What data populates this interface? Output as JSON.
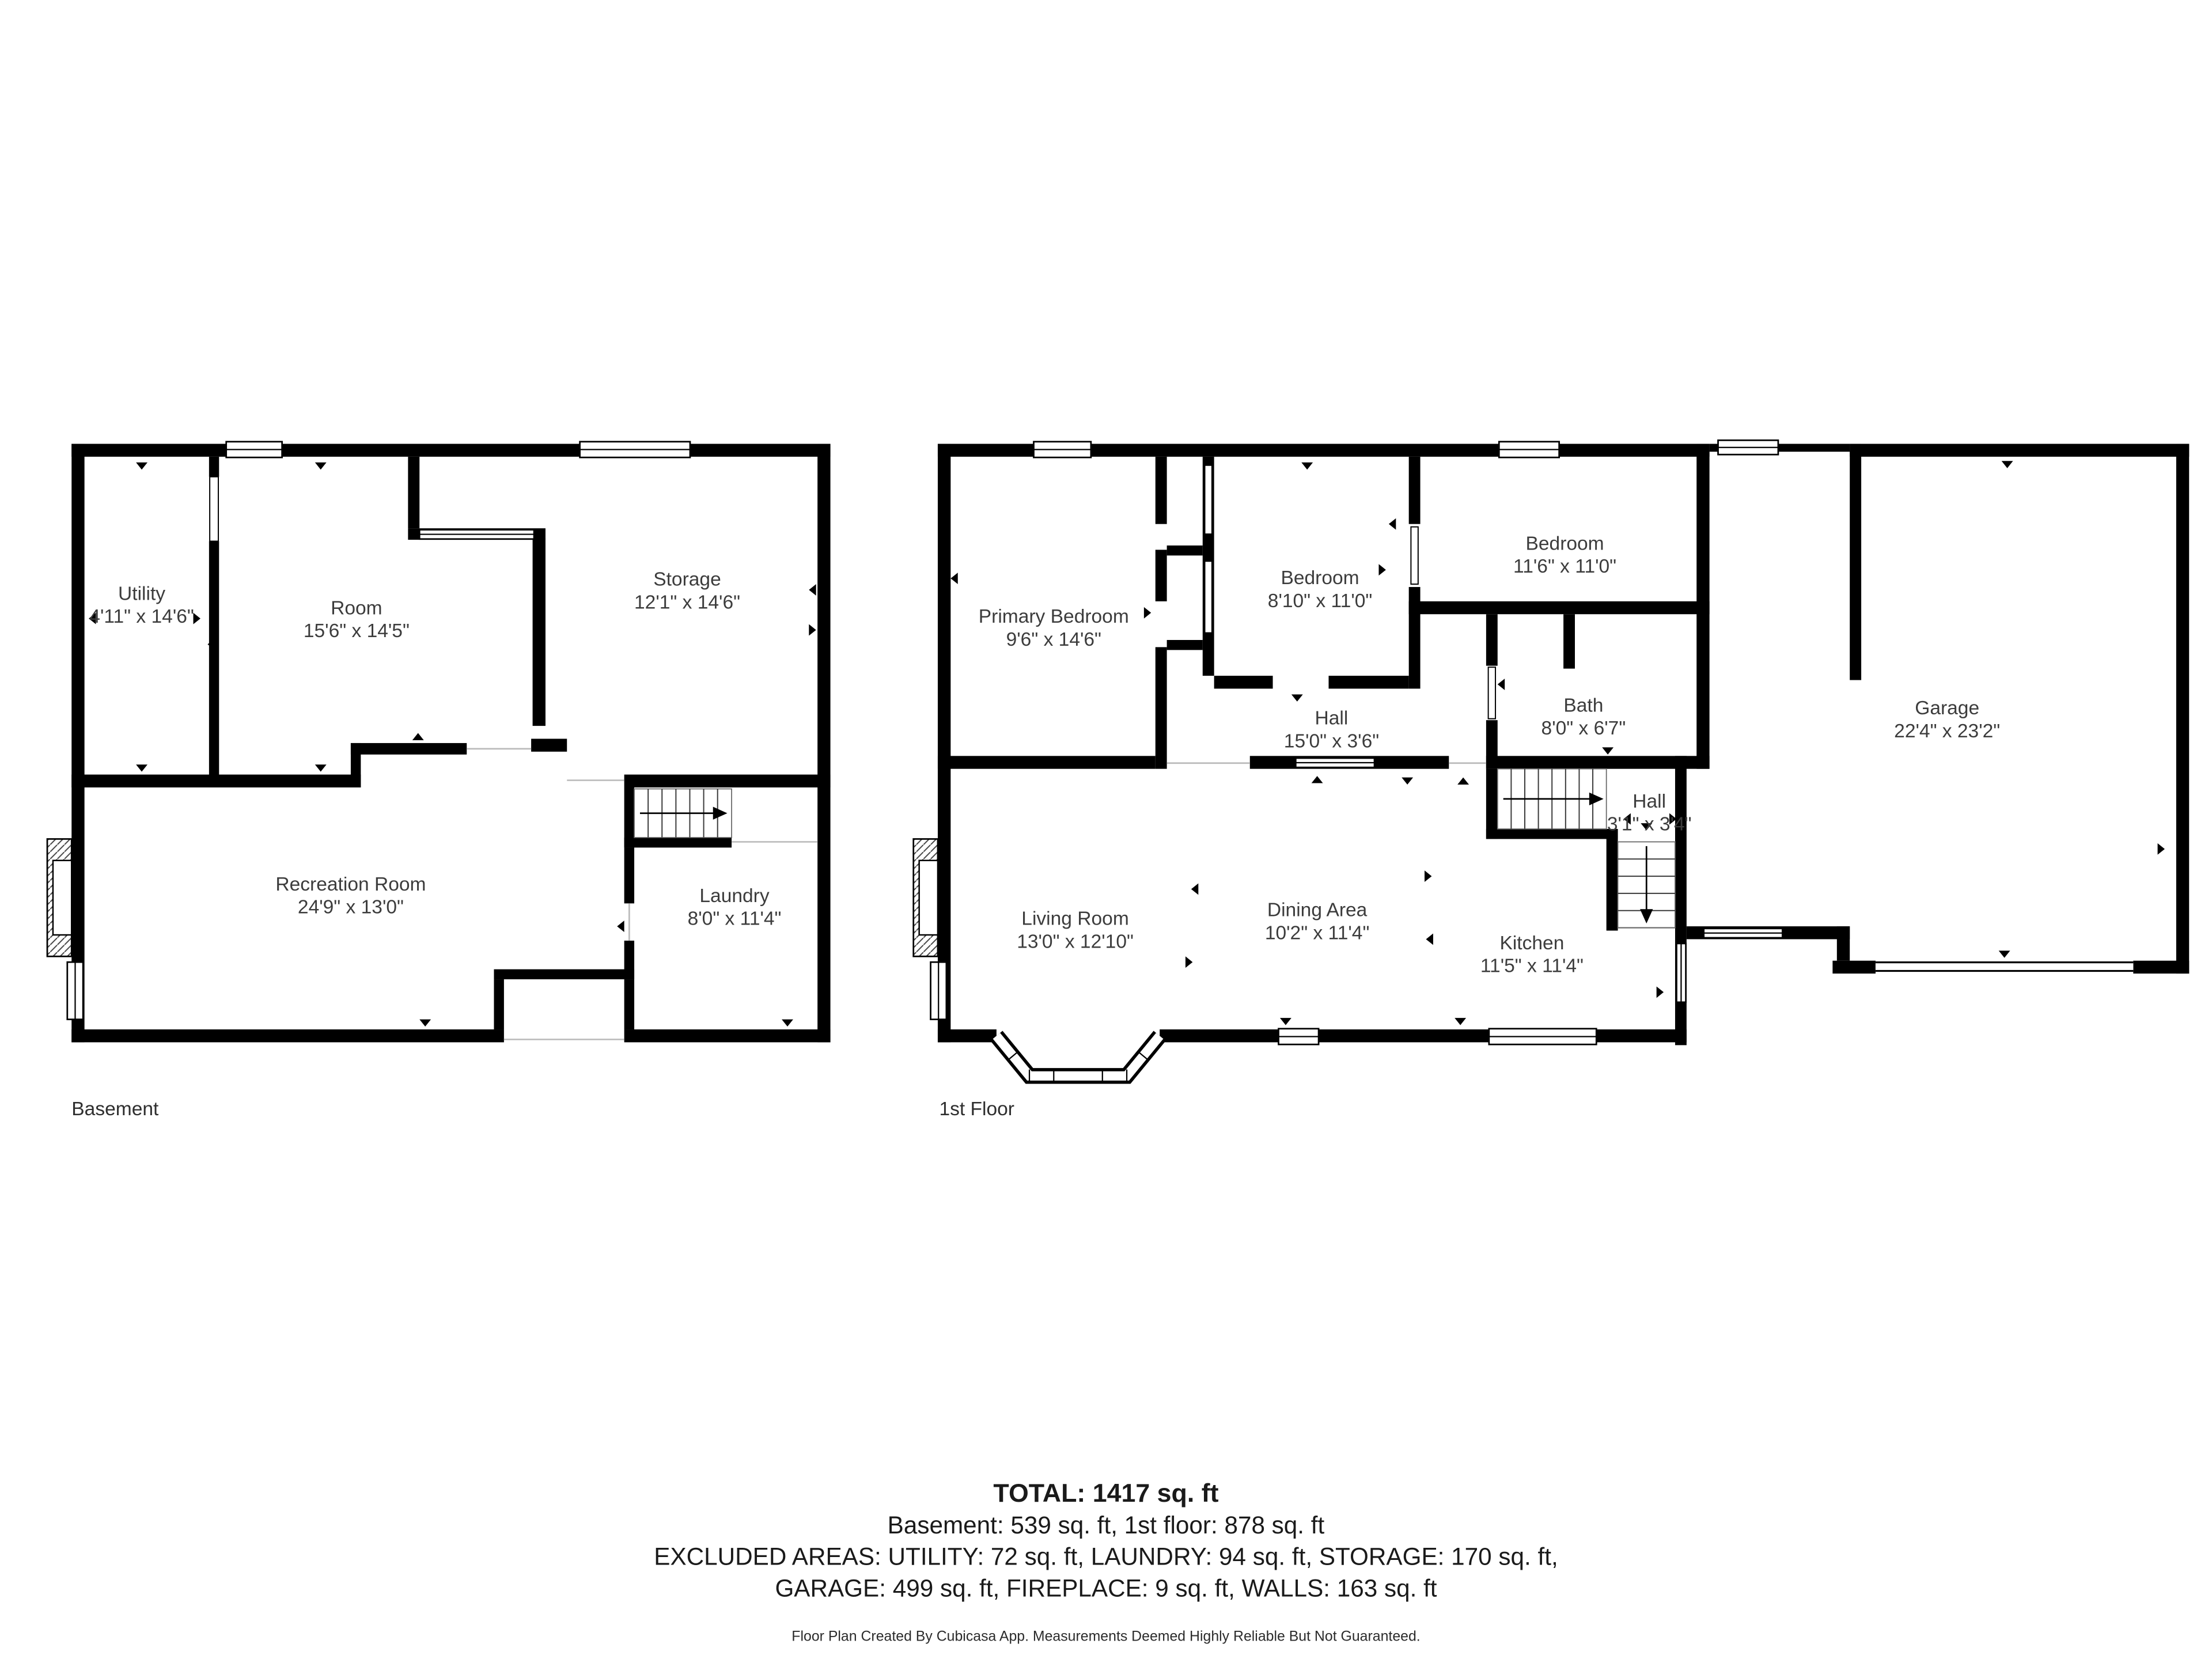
{
  "page": {
    "background": "#ffffff",
    "wall_color": "#000000",
    "label_color": "#3c3c3c"
  },
  "basement": {
    "title": "Basement",
    "rooms": {
      "utility": {
        "name": "Utility",
        "dims": "4'11\" x 14'6\""
      },
      "room": {
        "name": "Room",
        "dims": "15'6\" x 14'5\""
      },
      "storage": {
        "name": "Storage",
        "dims": "12'1\" x 14'6\""
      },
      "recreation_room": {
        "name": "Recreation Room",
        "dims": "24'9\" x 13'0\""
      },
      "laundry": {
        "name": "Laundry",
        "dims": "8'0\" x 11'4\""
      }
    }
  },
  "first_floor": {
    "title": "1st Floor",
    "rooms": {
      "primary_bedroom": {
        "name": "Primary Bedroom",
        "dims": "9'6\" x 14'6\""
      },
      "bedroom_small": {
        "name": "Bedroom",
        "dims": "8'10\" x 11'0\""
      },
      "bedroom_large": {
        "name": "Bedroom",
        "dims": "11'6\" x 11'0\""
      },
      "bath": {
        "name": "Bath",
        "dims": "8'0\" x 6'7\""
      },
      "hall": {
        "name": "Hall",
        "dims": "15'0\" x 3'6\""
      },
      "hall_small": {
        "name": "Hall",
        "dims": "3'1\" x 3'4\""
      },
      "living_room": {
        "name": "Living Room",
        "dims": "13'0\" x 12'10\""
      },
      "dining_area": {
        "name": "Dining Area",
        "dims": "10'2\" x 11'4\""
      },
      "kitchen": {
        "name": "Kitchen",
        "dims": "11'5\" x 11'4\""
      },
      "garage": {
        "name": "Garage",
        "dims": "22'4\" x 23'2\""
      }
    }
  },
  "summary": {
    "total": "TOTAL: 1417 sq. ft",
    "floors": "Basement: 539 sq. ft, 1st floor: 878 sq. ft",
    "excluded_1": "EXCLUDED AREAS: UTILITY: 72 sq. ft, LAUNDRY: 94 sq. ft, STORAGE: 170 sq. ft,",
    "excluded_2": "GARAGE: 499 sq. ft, FIREPLACE: 9 sq. ft, WALLS: 163 sq. ft"
  },
  "footer": "Floor Plan Created By Cubicasa App. Measurements Deemed Highly Reliable But Not Guaranteed."
}
